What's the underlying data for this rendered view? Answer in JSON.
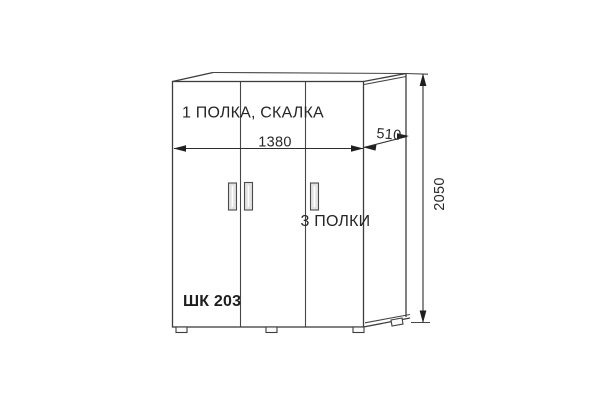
{
  "page": {
    "background": "#ffffff"
  },
  "drawing": {
    "type": "furniture-dimension-diagram",
    "model_label": "ШК 203",
    "labels": {
      "top_section": "1 ПОЛКА, СКАЛКА",
      "right_section": "3 ПОЛКИ"
    },
    "dimensions": {
      "width_mm": "1380",
      "depth_mm": "510",
      "height_mm": "2050"
    },
    "colors": {
      "line": "#3d3d3d",
      "text": "#262626",
      "arrow": "#1f1f1f",
      "handle_fill": "#e2e2e2"
    }
  }
}
